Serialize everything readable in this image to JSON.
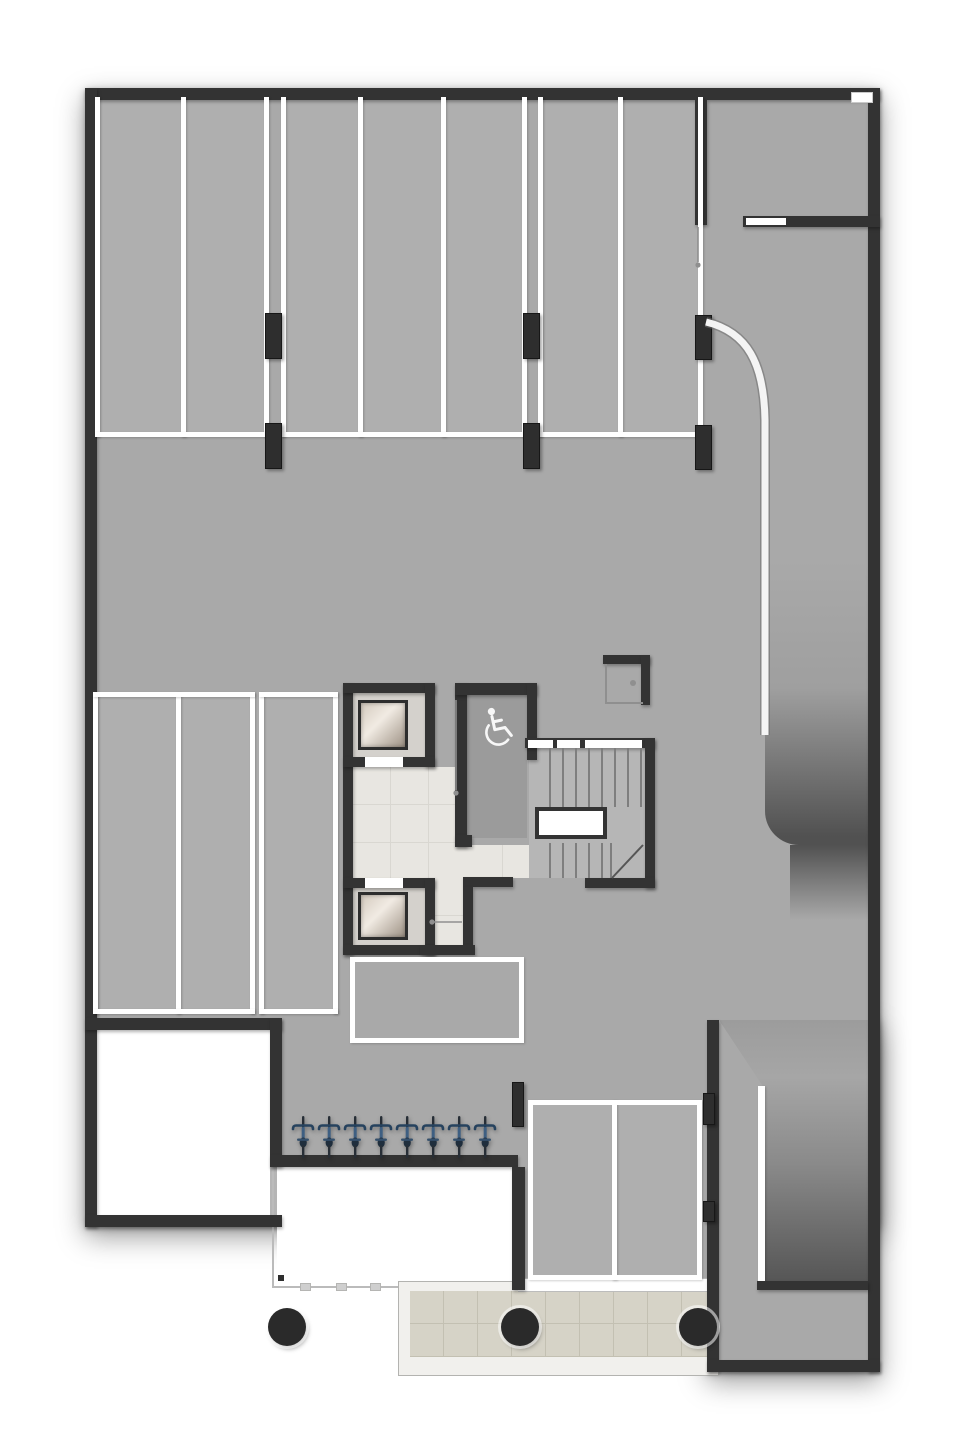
{
  "canvas": {
    "w": 963,
    "h": 1440
  },
  "colors": {
    "page": "#ffffff",
    "floor": "#a9a9a9",
    "wall": "#333333",
    "marking_white": "#ffffff",
    "marble": "#e8e6e1",
    "paving": "#d6d3c7",
    "ramp_dark": "#515151",
    "bike_blue": "#3e5f82",
    "bike_dark": "#272e36",
    "column_black": "#2a2a2a"
  },
  "icons": {
    "wheelchair_icon": "accessible-wc-symbol",
    "bicycle_icon": "bicycle-top-view",
    "door_handle_icon": "door-handle-dot"
  },
  "counts": {
    "top_row_stalls": 7,
    "mid_left_stalls": 3,
    "south_stalls": 2,
    "bicycles": 8,
    "elevators": 2,
    "round_columns": 3
  },
  "shadow_rects": [
    [
      85,
      88,
      795,
      1139
    ],
    [
      707,
      1020,
      173,
      352
    ]
  ],
  "floors": [
    {
      "n": "garage-floor-main",
      "r": [
        91,
        94,
        783,
        1067
      ]
    },
    {
      "n": "garage-floor-south",
      "r": [
        518,
        1155,
        196,
        135
      ]
    },
    {
      "n": "garage-floor-extension",
      "r": [
        713,
        1020,
        161,
        346
      ]
    }
  ],
  "stall_fills": [
    {
      "n": "top-stall-group-a-fill",
      "r": [
        95,
        97,
        173,
        340
      ]
    },
    {
      "n": "top-stall-group-b-fill",
      "r": [
        281,
        97,
        246,
        340
      ]
    },
    {
      "n": "top-stall-group-c-fill",
      "r": [
        538,
        97,
        165,
        340
      ]
    },
    {
      "n": "mid-left-stalls-fill",
      "r": [
        93,
        692,
        166,
        322
      ]
    },
    {
      "n": "mid-left-stall3-fill",
      "r": [
        259,
        692,
        79,
        322
      ]
    },
    {
      "n": "south-stalls-fill",
      "r": [
        528,
        1100,
        174,
        180
      ]
    }
  ],
  "ramp": {
    "upper": {
      "r": [
        765,
        560,
        103,
        285
      ]
    },
    "upper_fade": {
      "r": [
        790,
        845,
        78,
        75
      ]
    },
    "lower": {
      "r": [
        713,
        1020,
        157,
        261
      ],
      "clip": "polygon(6px 0px, 157px 0px, 157px 261px, 51px 261px, 51px 68px)"
    },
    "white_edge": [
      758,
      1086,
      7,
      197
    ],
    "curve_path": "M 706 322 C 748 332 764 364 765 420 L 765 735"
  },
  "white_rooms": [
    {
      "n": "unexcavated-room-west",
      "r": [
        97,
        1030,
        173,
        185
      ]
    },
    {
      "n": "unexcavated-room-south",
      "r": [
        277,
        1167,
        235,
        121
      ]
    }
  ],
  "thin_lines": [
    {
      "n": "room-south-left-edge",
      "r": [
        272,
        1167,
        2,
        121
      ]
    },
    {
      "n": "room-south-bottom-edge",
      "r": [
        272,
        1286,
        242,
        2
      ]
    }
  ],
  "ticks": [
    [
      300,
      1283
    ],
    [
      336,
      1283
    ],
    [
      370,
      1283
    ],
    [
      404,
      1283
    ],
    [
      438,
      1283
    ],
    [
      472,
      1283
    ]
  ],
  "corner_marker": [
    275,
    1272,
    12,
    12
  ],
  "paving": {
    "frame": [
      398,
      1281,
      319,
      93
    ],
    "tiles": [
      410,
      1291,
      302,
      66
    ]
  },
  "facade_band": [
    518,
    1278,
    196,
    12
  ],
  "walls": [
    {
      "n": "wall-top",
      "r": [
        85,
        88,
        795,
        12
      ]
    },
    {
      "n": "wall-left",
      "r": [
        85,
        88,
        12,
        1139
      ]
    },
    {
      "n": "wall-right",
      "r": [
        868,
        88,
        12,
        1284
      ]
    },
    {
      "n": "wall-bottom-left",
      "r": [
        85,
        1215,
        197,
        12
      ]
    },
    {
      "n": "wall-room-west-top",
      "r": [
        85,
        1018,
        197,
        12
      ]
    },
    {
      "n": "wall-room-west-right",
      "r": [
        270,
        1018,
        12,
        149
      ]
    },
    {
      "n": "wall-south-mid",
      "r": [
        270,
        1155,
        248,
        12
      ]
    },
    {
      "n": "wall-room-south-right",
      "r": [
        512,
        1167,
        13,
        123
      ]
    },
    {
      "n": "wall-extension-left",
      "r": [
        707,
        1020,
        12,
        352
      ]
    },
    {
      "n": "wall-extension-bottom",
      "r": [
        707,
        1360,
        173,
        12
      ]
    },
    {
      "n": "wall-extension-inner",
      "r": [
        757,
        1281,
        111,
        9
      ]
    },
    {
      "n": "wall-topright-room-vert",
      "r": [
        695,
        100,
        12,
        125
      ]
    },
    {
      "n": "wall-topright-room-horiz",
      "r": [
        743,
        216,
        137,
        11
      ]
    },
    {
      "n": "core-wall-left",
      "r": [
        343,
        683,
        10,
        272
      ]
    },
    {
      "n": "core-shaft1-top",
      "r": [
        343,
        683,
        92,
        10
      ]
    },
    {
      "n": "core-shaft1-right",
      "r": [
        425,
        683,
        10,
        84
      ]
    },
    {
      "n": "core-shaft1-bottom",
      "r": [
        343,
        757,
        92,
        10
      ]
    },
    {
      "n": "core-shaft2-top",
      "r": [
        343,
        878,
        92,
        10
      ]
    },
    {
      "n": "core-shaft2-right",
      "r": [
        425,
        878,
        10,
        77
      ]
    },
    {
      "n": "core-shaft2-bottom",
      "r": [
        343,
        945,
        92,
        10
      ]
    },
    {
      "n": "core-wc-left",
      "r": [
        455,
        683,
        12,
        164
      ]
    },
    {
      "n": "core-wc-top",
      "r": [
        455,
        683,
        82,
        12
      ]
    },
    {
      "n": "core-wc-right",
      "r": [
        527,
        683,
        10,
        77
      ]
    },
    {
      "n": "core-stair-top",
      "r": [
        525,
        738,
        130,
        10
      ]
    },
    {
      "n": "core-stair-right",
      "r": [
        645,
        738,
        10,
        150
      ]
    },
    {
      "n": "core-stair-bottom",
      "r": [
        585,
        878,
        70,
        10
      ]
    },
    {
      "n": "core-corridor-top",
      "r": [
        463,
        877,
        50,
        10
      ]
    },
    {
      "n": "core-corridor-right",
      "r": [
        463,
        887,
        10,
        58
      ]
    },
    {
      "n": "core-corridor-bottom",
      "r": [
        420,
        945,
        55,
        10
      ]
    },
    {
      "n": "core-wc-stub",
      "r": [
        455,
        835,
        17,
        12
      ]
    }
  ],
  "wall_openings": [
    {
      "n": "elevator1-door-opening",
      "r": [
        365,
        757,
        38,
        10
      ]
    },
    {
      "n": "elevator2-door-opening",
      "r": [
        365,
        878,
        38,
        10
      ]
    },
    {
      "n": "stair-door-opening-1",
      "r": [
        528,
        740,
        25,
        8
      ]
    },
    {
      "n": "stair-door-opening-2",
      "r": [
        557,
        740,
        23,
        8
      ]
    },
    {
      "n": "stair-door-opening-3",
      "r": [
        585,
        740,
        57,
        8
      ]
    },
    {
      "n": "topright-room-door",
      "r": [
        746,
        218,
        40,
        7
      ]
    }
  ],
  "top_right_notch": [
    851,
    92,
    20,
    9
  ],
  "white_lines": [
    {
      "n": "stall-line-v",
      "r": [
        95,
        97,
        5,
        340
      ]
    },
    {
      "n": "stall-line-v",
      "r": [
        181,
        97,
        5,
        340
      ]
    },
    {
      "n": "stall-line-v",
      "r": [
        264,
        97,
        5,
        340
      ]
    },
    {
      "n": "stall-line-v",
      "r": [
        281,
        97,
        5,
        340
      ]
    },
    {
      "n": "stall-line-v",
      "r": [
        358,
        97,
        5,
        340
      ]
    },
    {
      "n": "stall-line-v",
      "r": [
        441,
        97,
        5,
        340
      ]
    },
    {
      "n": "stall-line-v",
      "r": [
        522,
        97,
        5,
        340
      ]
    },
    {
      "n": "stall-line-v",
      "r": [
        538,
        97,
        5,
        340
      ]
    },
    {
      "n": "stall-line-v",
      "r": [
        618,
        97,
        5,
        340
      ]
    },
    {
      "n": "stall-line-v",
      "r": [
        698,
        97,
        5,
        340
      ]
    },
    {
      "n": "stall-line-h",
      "r": [
        95,
        432,
        174,
        5
      ]
    },
    {
      "n": "stall-line-h",
      "r": [
        281,
        432,
        246,
        5
      ]
    },
    {
      "n": "stall-line-h",
      "r": [
        538,
        432,
        165,
        5
      ]
    },
    {
      "n": "stall-line-v",
      "r": [
        93,
        692,
        5,
        322
      ]
    },
    {
      "n": "stall-line-v",
      "r": [
        176,
        692,
        5,
        322
      ]
    },
    {
      "n": "stall-line-v",
      "r": [
        250,
        692,
        5,
        322
      ]
    },
    {
      "n": "stall-line-v",
      "r": [
        259,
        692,
        5,
        322
      ]
    },
    {
      "n": "stall-line-v",
      "r": [
        333,
        692,
        5,
        322
      ]
    },
    {
      "n": "stall-line-h",
      "r": [
        93,
        692,
        162,
        5
      ]
    },
    {
      "n": "stall-line-h",
      "r": [
        93,
        1009,
        162,
        5
      ]
    },
    {
      "n": "stall-line-h",
      "r": [
        259,
        692,
        79,
        5
      ]
    },
    {
      "n": "stall-line-h",
      "r": [
        259,
        1009,
        79,
        5
      ]
    },
    {
      "n": "stall-line-v",
      "r": [
        612,
        1100,
        5,
        180
      ]
    }
  ],
  "outline_boxes": [
    {
      "n": "storage-bay-outline",
      "r": [
        350,
        957,
        174,
        86
      ]
    },
    {
      "n": "south-stalls-outline",
      "r": [
        528,
        1100,
        174,
        180
      ]
    }
  ],
  "columns_rect": [
    {
      "n": "pier-column",
      "r": [
        265,
        313,
        17,
        46
      ]
    },
    {
      "n": "pier-column",
      "r": [
        265,
        423,
        17,
        46
      ]
    },
    {
      "n": "pier-column",
      "r": [
        523,
        313,
        17,
        46
      ]
    },
    {
      "n": "pier-column",
      "r": [
        523,
        423,
        17,
        46
      ]
    },
    {
      "n": "pier-column",
      "r": [
        695,
        315,
        17,
        45
      ]
    },
    {
      "n": "pier-column",
      "r": [
        695,
        425,
        17,
        45
      ]
    },
    {
      "n": "pier-column",
      "r": [
        512,
        1082,
        12,
        45
      ]
    },
    {
      "n": "pier-column",
      "r": [
        703,
        1093,
        12,
        32
      ]
    },
    {
      "n": "pier-column",
      "r": [
        703,
        1201,
        12,
        21
      ]
    }
  ],
  "columns_round": {
    "radius": 19,
    "centers": [
      [
        287,
        1327
      ],
      [
        520,
        1327
      ],
      [
        698,
        1327
      ]
    ]
  },
  "bikes": {
    "count": 8,
    "first_cx": 303,
    "spacing": 26,
    "top": 1116,
    "w": 24,
    "h": 42
  },
  "core": {
    "marble": [
      [
        353,
        767,
        112,
        111
      ],
      [
        427,
        878,
        38,
        69
      ],
      [
        465,
        845,
        64,
        33
      ]
    ],
    "wc_floor": [
      467,
      695,
      60,
      143
    ],
    "stair_floor": [
      529,
      748,
      118,
      130
    ],
    "shaft_bg": [
      [
        353,
        693,
        72,
        64
      ],
      [
        353,
        888,
        72,
        57
      ]
    ],
    "cabs": [
      [
        358,
        700,
        50,
        50
      ],
      [
        358,
        892,
        50,
        48
      ]
    ],
    "landing": [
      535,
      807,
      72,
      32
    ],
    "treads_upper": {
      "x0": 549,
      "step": 13,
      "count": 8,
      "y": 748,
      "h": 59
    },
    "treads_lower": {
      "x0": 549,
      "step": 13,
      "count": 5,
      "y": 843,
      "h": 35
    },
    "flight_divider": [
      610,
      843,
      2,
      35
    ],
    "stair_diagonal": [
      612,
      878,
      643,
      845
    ],
    "closet": {
      "top": [
        603,
        655,
        47,
        9
      ],
      "right": [
        641,
        655,
        9,
        50
      ],
      "left_thin": [
        605,
        664,
        2,
        40
      ],
      "bottom_thin": [
        605,
        702,
        38,
        2
      ],
      "handle": [
        630,
        680,
        6,
        6
      ]
    },
    "wheelchair": {
      "x": 476,
      "y": 704,
      "rot": -12
    }
  },
  "door_leaves": [
    {
      "line": [
        698,
        227,
        698,
        262
      ],
      "dot": [
        698,
        265
      ]
    },
    {
      "line": [
        456,
        700,
        456,
        790
      ],
      "dot": [
        456,
        793
      ]
    },
    {
      "line": [
        434,
        922,
        462,
        922
      ],
      "dot": [
        432,
        922
      ]
    }
  ]
}
